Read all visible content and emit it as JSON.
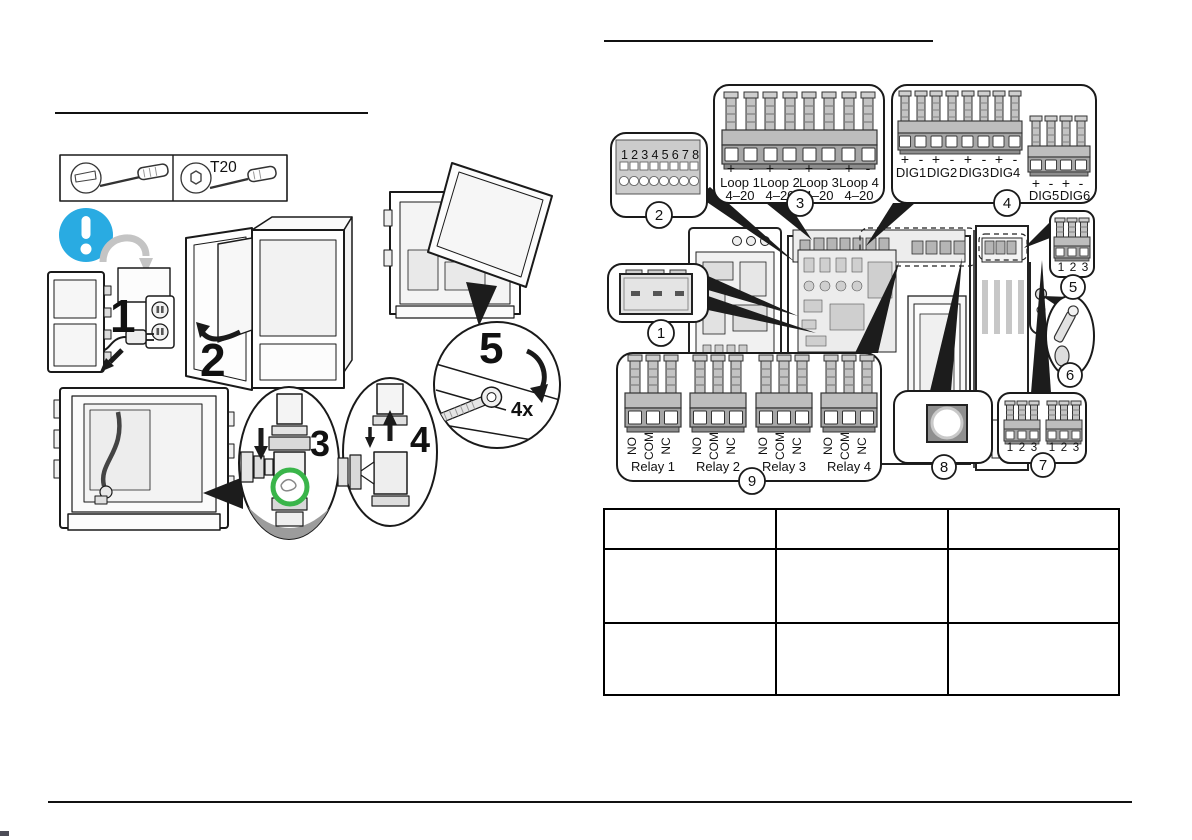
{
  "left_figure": {
    "torx_label": "T20",
    "steps": [
      "1",
      "2",
      "3",
      "4",
      "5"
    ],
    "screw_count": "4x"
  },
  "right_figure": {
    "callouts": [
      "1",
      "2",
      "3",
      "4",
      "5",
      "6",
      "7",
      "8",
      "9"
    ],
    "dip_digits": "12345678",
    "signs": {
      "plus": "+",
      "minus": "-"
    },
    "loops": [
      {
        "name": "Loop 1",
        "range": "4–20"
      },
      {
        "name": "Loop 2",
        "range": "4–20"
      },
      {
        "name": "Loop 3",
        "range": "4–20"
      },
      {
        "name": "Loop 4",
        "range": "4–20"
      }
    ],
    "dig_row1": [
      "DIG1",
      "DIG2",
      "DIG3",
      "DIG4"
    ],
    "dig_row2": [
      "DIG5",
      "DIG6"
    ],
    "pin_numbers": [
      "1",
      "2",
      "3"
    ],
    "relay_pins": [
      "NO",
      "COM",
      "NC"
    ],
    "relays": [
      "Relay 1",
      "Relay 2",
      "Relay 3",
      "Relay 4"
    ]
  },
  "colors": {
    "accent_blue": "#29ABE2",
    "accent_green": "#3AB54A"
  },
  "table": {
    "rows": [
      [
        "",
        "",
        ""
      ],
      [
        "",
        "",
        ""
      ],
      [
        "",
        "",
        ""
      ]
    ]
  }
}
